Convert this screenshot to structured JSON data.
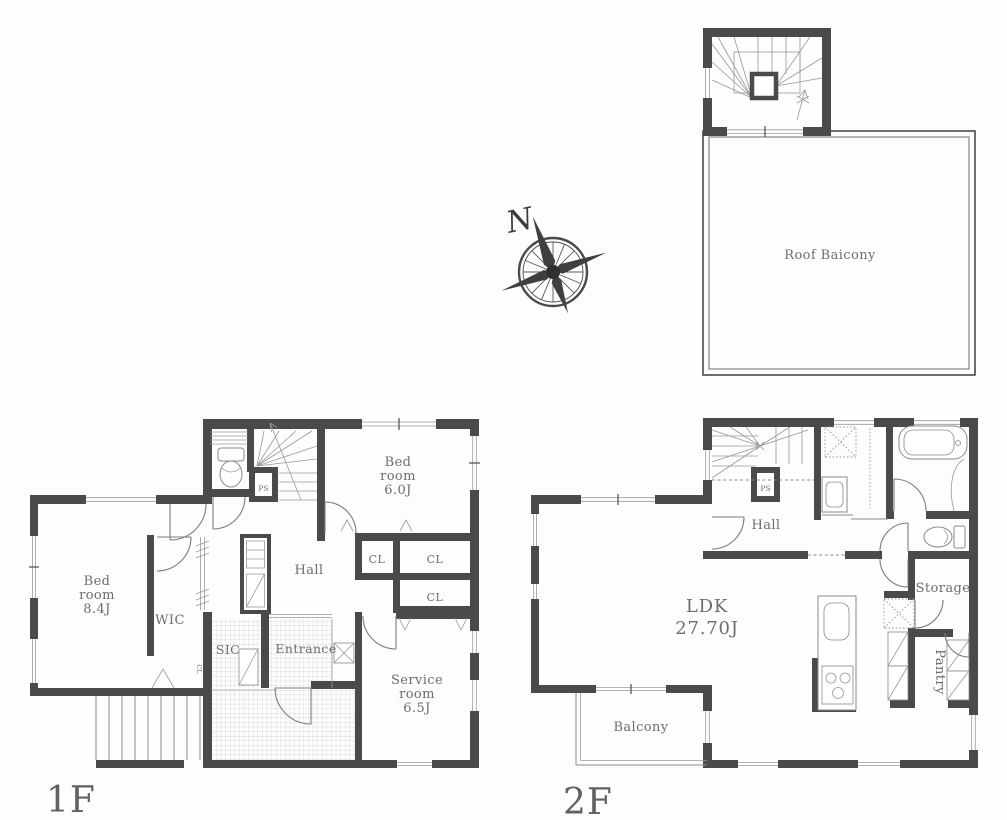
{
  "document": {
    "type": "floor-plan",
    "background": "#fdfdfd"
  },
  "colors": {
    "wall": "#4a4a4c",
    "fixture_line": "#8a8a8a",
    "text": "#6d6d6d",
    "tile_grid": "#cbcbcb"
  },
  "compass": {
    "north_label": "N"
  },
  "roof": {
    "balcony_label": "Roof Baicony"
  },
  "floor1": {
    "floor_label": "1F",
    "bedroom_main": {
      "l1": "Bed",
      "l2": "room",
      "l3": "8.4J"
    },
    "bedroom_second": {
      "l1": "Bed",
      "l2": "room",
      "l3": "6.0J"
    },
    "service_room": {
      "l1": "Service",
      "l2": "room",
      "l3": "6.5J"
    },
    "wic": "WIC",
    "sic": "SIC",
    "entrance": "Entrance",
    "hall": "Hall",
    "closet1": "CL",
    "closet2": "CL",
    "closet3": "CL",
    "closet_small": "CL",
    "pipe_space": "PS"
  },
  "floor2": {
    "floor_label": "2F",
    "ldk": {
      "l1": "LDK",
      "l2": "27.70J"
    },
    "hall": "Hall",
    "pipe_space": "PS",
    "storage": "Storage",
    "pantry": "Pantry",
    "balcony": "Balcony"
  }
}
